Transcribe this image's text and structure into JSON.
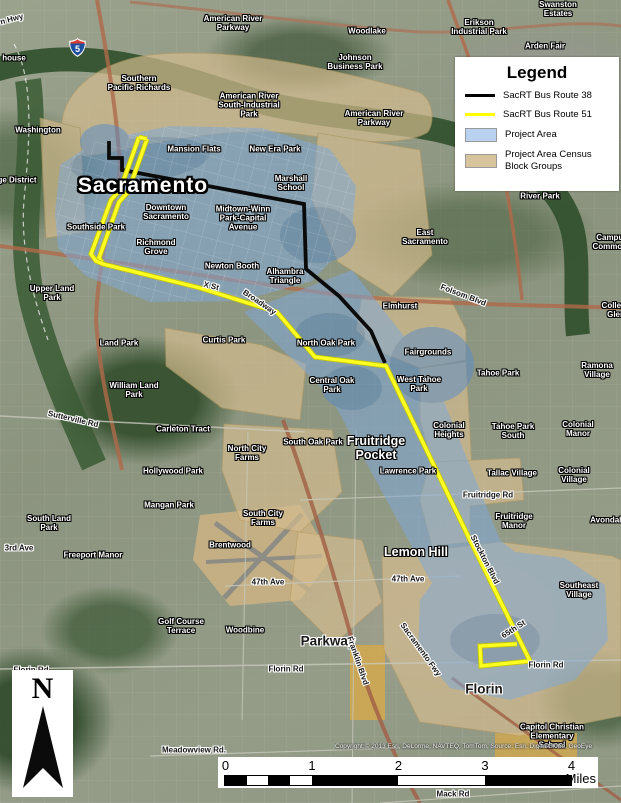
{
  "legend": {
    "title": "Legend",
    "items": [
      {
        "label": "SacRT Bus Route 38",
        "type": "line",
        "color": "#000000"
      },
      {
        "label": "SacRT Bus Route 51",
        "type": "line",
        "color": "#ffff00"
      },
      {
        "label": "Project Area",
        "type": "fill",
        "color": "#b8d2f0"
      },
      {
        "label": "Project Area Census\nBlock Groups",
        "type": "fill",
        "color": "#d8c49c"
      }
    ]
  },
  "north_arrow": {
    "label": "N"
  },
  "scale_bar": {
    "unit": "Miles",
    "pixels_per_mile": 86.5,
    "ticks": [
      {
        "label": "0",
        "mile": 0
      },
      {
        "label": "1",
        "mile": 1
      },
      {
        "label": "2",
        "mile": 2
      },
      {
        "label": "3",
        "mile": 3
      },
      {
        "label": "4",
        "mile": 4
      }
    ],
    "segments": [
      {
        "start": 0,
        "end": 0.25,
        "fill": "#000"
      },
      {
        "start": 0.25,
        "end": 0.5,
        "fill": "#fff"
      },
      {
        "start": 0.5,
        "end": 0.75,
        "fill": "#000"
      },
      {
        "start": 0.75,
        "end": 1,
        "fill": "#fff"
      },
      {
        "start": 1,
        "end": 2,
        "fill": "#000"
      },
      {
        "start": 2,
        "end": 3,
        "fill": "#fff"
      },
      {
        "start": 3,
        "end": 4,
        "fill": "#000"
      }
    ]
  },
  "shields": [
    {
      "type": "interstate",
      "number": "5"
    }
  ],
  "attribution": "Copyright:© 2013 Esri, DeLorme, NAVTEQ, TomTom, Source: Esri, DigitalGlobe, GeoEye",
  "colors": {
    "route_38": "#0a0a0a",
    "route_51": "#ffff22",
    "route_51_casing": "#c9c900",
    "project_area": "#7ea9dc",
    "project_area_dark": "#5b8cc8",
    "census_blocks": "#d6bd8f",
    "river": "#32502e",
    "highway": "#b06a4a"
  },
  "routes": [
    {
      "name": "sacrt-bus-route-38",
      "color": "#0a0a0a",
      "width": 3.8,
      "casing": false,
      "segments": [
        "109,141 109,158 122,158 122,170 304,204 306,269 339,296 371,331 385,363"
      ]
    },
    {
      "name": "sacrt-bus-route-51",
      "color": "#ffff22",
      "width": 3.2,
      "casing": true,
      "segments": [
        "147,139 128,192 119,202 99,258 103,264 200,288 277,312 315,357 386,366 470,540 530,661 481,666 480,646 517,644",
        "139,137 120,190 111,200 91,254 96,261 103,264",
        "139,137 147,139"
      ]
    }
  ],
  "map_labels": [
    {
      "t": "n Hwy",
      "x": 12,
      "y": 20,
      "c": "road",
      "r": -15
    },
    {
      "t": "house",
      "x": 14,
      "y": 59,
      "c": "place"
    },
    {
      "t": "American River\nParkway",
      "x": 233,
      "y": 24,
      "c": "place"
    },
    {
      "t": "Woodlake",
      "x": 367,
      "y": 32,
      "c": "place"
    },
    {
      "t": "Erikson\nIndustrial Park",
      "x": 479,
      "y": 28,
      "c": "place"
    },
    {
      "t": "Swanston\nEstates",
      "x": 558,
      "y": 10,
      "c": "place"
    },
    {
      "t": "Arden Fair",
      "x": 545,
      "y": 47,
      "c": "place"
    },
    {
      "t": "Johnson\nBusiness Park",
      "x": 355,
      "y": 63,
      "c": "place"
    },
    {
      "t": "Southern\nPacific-Richards",
      "x": 139,
      "y": 84,
      "c": "place"
    },
    {
      "t": "American River\nSouth-Industrial\nPark",
      "x": 249,
      "y": 106,
      "c": "place"
    },
    {
      "t": "American River\nParkway",
      "x": 374,
      "y": 119,
      "c": "place"
    },
    {
      "t": "Washington",
      "x": 38,
      "y": 131,
      "c": "place"
    },
    {
      "t": "ge District",
      "x": 17,
      "y": 181,
      "c": "place"
    },
    {
      "t": "Mansion Flats",
      "x": 194,
      "y": 150,
      "c": "place"
    },
    {
      "t": "New Era Park",
      "x": 275,
      "y": 150,
      "c": "place"
    },
    {
      "t": "Sacramento",
      "x": 143,
      "y": 186,
      "c": "city"
    },
    {
      "t": "Marshall\nSchool",
      "x": 291,
      "y": 184,
      "c": "place"
    },
    {
      "t": "Downtown\nSacramento",
      "x": 166,
      "y": 213,
      "c": "place"
    },
    {
      "t": "Midtown-Winn\nPark-Capital\nAvenue",
      "x": 243,
      "y": 219,
      "c": "place"
    },
    {
      "t": "Southside Park",
      "x": 96,
      "y": 228,
      "c": "place"
    },
    {
      "t": "Richmond\nGrove",
      "x": 156,
      "y": 248,
      "c": "place"
    },
    {
      "t": "Newton Booth",
      "x": 232,
      "y": 267,
      "c": "place"
    },
    {
      "t": "Alhambra\nTriangle",
      "x": 285,
      "y": 277,
      "c": "place"
    },
    {
      "t": "East\nSacramento",
      "x": 425,
      "y": 238,
      "c": "place"
    },
    {
      "t": "River Park",
      "x": 540,
      "y": 197,
      "c": "place"
    },
    {
      "t": "Campus\nCommons",
      "x": 612,
      "y": 243,
      "c": "place"
    },
    {
      "t": "Upper Land\nPark",
      "x": 52,
      "y": 294,
      "c": "place"
    },
    {
      "t": "X St",
      "x": 211,
      "y": 287,
      "c": "road",
      "r": 14
    },
    {
      "t": "Broadway",
      "x": 259,
      "y": 303,
      "c": "road",
      "r": 34
    },
    {
      "t": "Elmhurst",
      "x": 400,
      "y": 307,
      "c": "place"
    },
    {
      "t": "Folsom Blvd",
      "x": 463,
      "y": 296,
      "c": "road",
      "r": 21
    },
    {
      "t": "Ramona Village",
      "x": 597,
      "y": 371,
      "c": "place"
    },
    {
      "t": "Land Park",
      "x": 119,
      "y": 344,
      "c": "place"
    },
    {
      "t": "Curtis Park",
      "x": 224,
      "y": 341,
      "c": "place"
    },
    {
      "t": "North Oak Park",
      "x": 326,
      "y": 344,
      "c": "place"
    },
    {
      "t": "Fairgrounds",
      "x": 428,
      "y": 353,
      "c": "place"
    },
    {
      "t": "West Tahoe\nPark",
      "x": 419,
      "y": 385,
      "c": "place"
    },
    {
      "t": "Tahoe Park",
      "x": 498,
      "y": 374,
      "c": "place"
    },
    {
      "t": "Central Oak\nPark",
      "x": 332,
      "y": 386,
      "c": "place"
    },
    {
      "t": "William Land\nPark",
      "x": 134,
      "y": 391,
      "c": "place"
    },
    {
      "t": "Sutterville Rd",
      "x": 73,
      "y": 420,
      "c": "road",
      "r": 13
    },
    {
      "t": "Carleton Tract",
      "x": 183,
      "y": 430,
      "c": "place"
    },
    {
      "t": "North City\nFarms",
      "x": 247,
      "y": 454,
      "c": "place"
    },
    {
      "t": "South Oak Park",
      "x": 313,
      "y": 443,
      "c": "place"
    },
    {
      "t": "Colonial\nHeights",
      "x": 449,
      "y": 431,
      "c": "place"
    },
    {
      "t": "Tahoe Park\nSouth",
      "x": 513,
      "y": 432,
      "c": "place"
    },
    {
      "t": "Tallac Village",
      "x": 512,
      "y": 474,
      "c": "place"
    },
    {
      "t": "Colonial Manor",
      "x": 578,
      "y": 430,
      "c": "place"
    },
    {
      "t": "Colonial Village",
      "x": 574,
      "y": 476,
      "c": "place"
    },
    {
      "t": "Avondale",
      "x": 608,
      "y": 521,
      "c": "place"
    },
    {
      "t": "Lawrence Park",
      "x": 408,
      "y": 472,
      "c": "place"
    },
    {
      "t": "Fruitridge\nPocket",
      "x": 376,
      "y": 448,
      "c": "area"
    },
    {
      "t": "Fruitridge Rd",
      "x": 488,
      "y": 496,
      "c": "road"
    },
    {
      "t": "Fruitridge\nManor",
      "x": 514,
      "y": 522,
      "c": "place"
    },
    {
      "t": "Hollywood Park",
      "x": 173,
      "y": 472,
      "c": "place"
    },
    {
      "t": "Mangan Park",
      "x": 169,
      "y": 506,
      "c": "place"
    },
    {
      "t": "South City\nFarms",
      "x": 263,
      "y": 519,
      "c": "place"
    },
    {
      "t": "South Land\nPark",
      "x": 49,
      "y": 524,
      "c": "place"
    },
    {
      "t": "Brentwood",
      "x": 230,
      "y": 546,
      "c": "place"
    },
    {
      "t": "Freeport Manor",
      "x": 93,
      "y": 556,
      "c": "place"
    },
    {
      "t": "3rd Ave",
      "x": 19,
      "y": 549,
      "c": "road"
    },
    {
      "t": "Lemon Hill",
      "x": 416,
      "y": 552,
      "c": "area"
    },
    {
      "t": "47th Ave",
      "x": 268,
      "y": 583,
      "c": "road"
    },
    {
      "t": "47th Ave",
      "x": 408,
      "y": 580,
      "c": "road"
    },
    {
      "t": "Stockton Blvd",
      "x": 484,
      "y": 560,
      "c": "road",
      "r": 63
    },
    {
      "t": "Southeast\nVillage",
      "x": 579,
      "y": 591,
      "c": "place"
    },
    {
      "t": "Golf Course\nTerrace",
      "x": 181,
      "y": 627,
      "c": "place"
    },
    {
      "t": "Woodbine",
      "x": 245,
      "y": 631,
      "c": "place"
    },
    {
      "t": "Parkway",
      "x": 328,
      "y": 641,
      "c": "town"
    },
    {
      "t": "Franklin Blvd",
      "x": 357,
      "y": 661,
      "c": "road",
      "r": 71
    },
    {
      "t": "Sacramento Fwy",
      "x": 420,
      "y": 650,
      "c": "road",
      "r": 54
    },
    {
      "t": "65th St",
      "x": 514,
      "y": 630,
      "c": "road",
      "r": -33
    },
    {
      "t": "Florin Rd",
      "x": 31,
      "y": 671,
      "c": "road"
    },
    {
      "t": "Florin Rd",
      "x": 286,
      "y": 670,
      "c": "road"
    },
    {
      "t": "Florin Rd",
      "x": 546,
      "y": 666,
      "c": "road"
    },
    {
      "t": "Florin",
      "x": 484,
      "y": 689,
      "c": "town"
    },
    {
      "t": "Capitol Christian\nElementary\nSchool",
      "x": 552,
      "y": 737,
      "c": "place"
    },
    {
      "t": "Meadowview Rd.",
      "x": 194,
      "y": 751,
      "c": "road"
    },
    {
      "t": "Mack Rd",
      "x": 453,
      "y": 795,
      "c": "road"
    },
    {
      "t": "College Glen",
      "x": 616,
      "y": 311,
      "c": "place"
    }
  ]
}
